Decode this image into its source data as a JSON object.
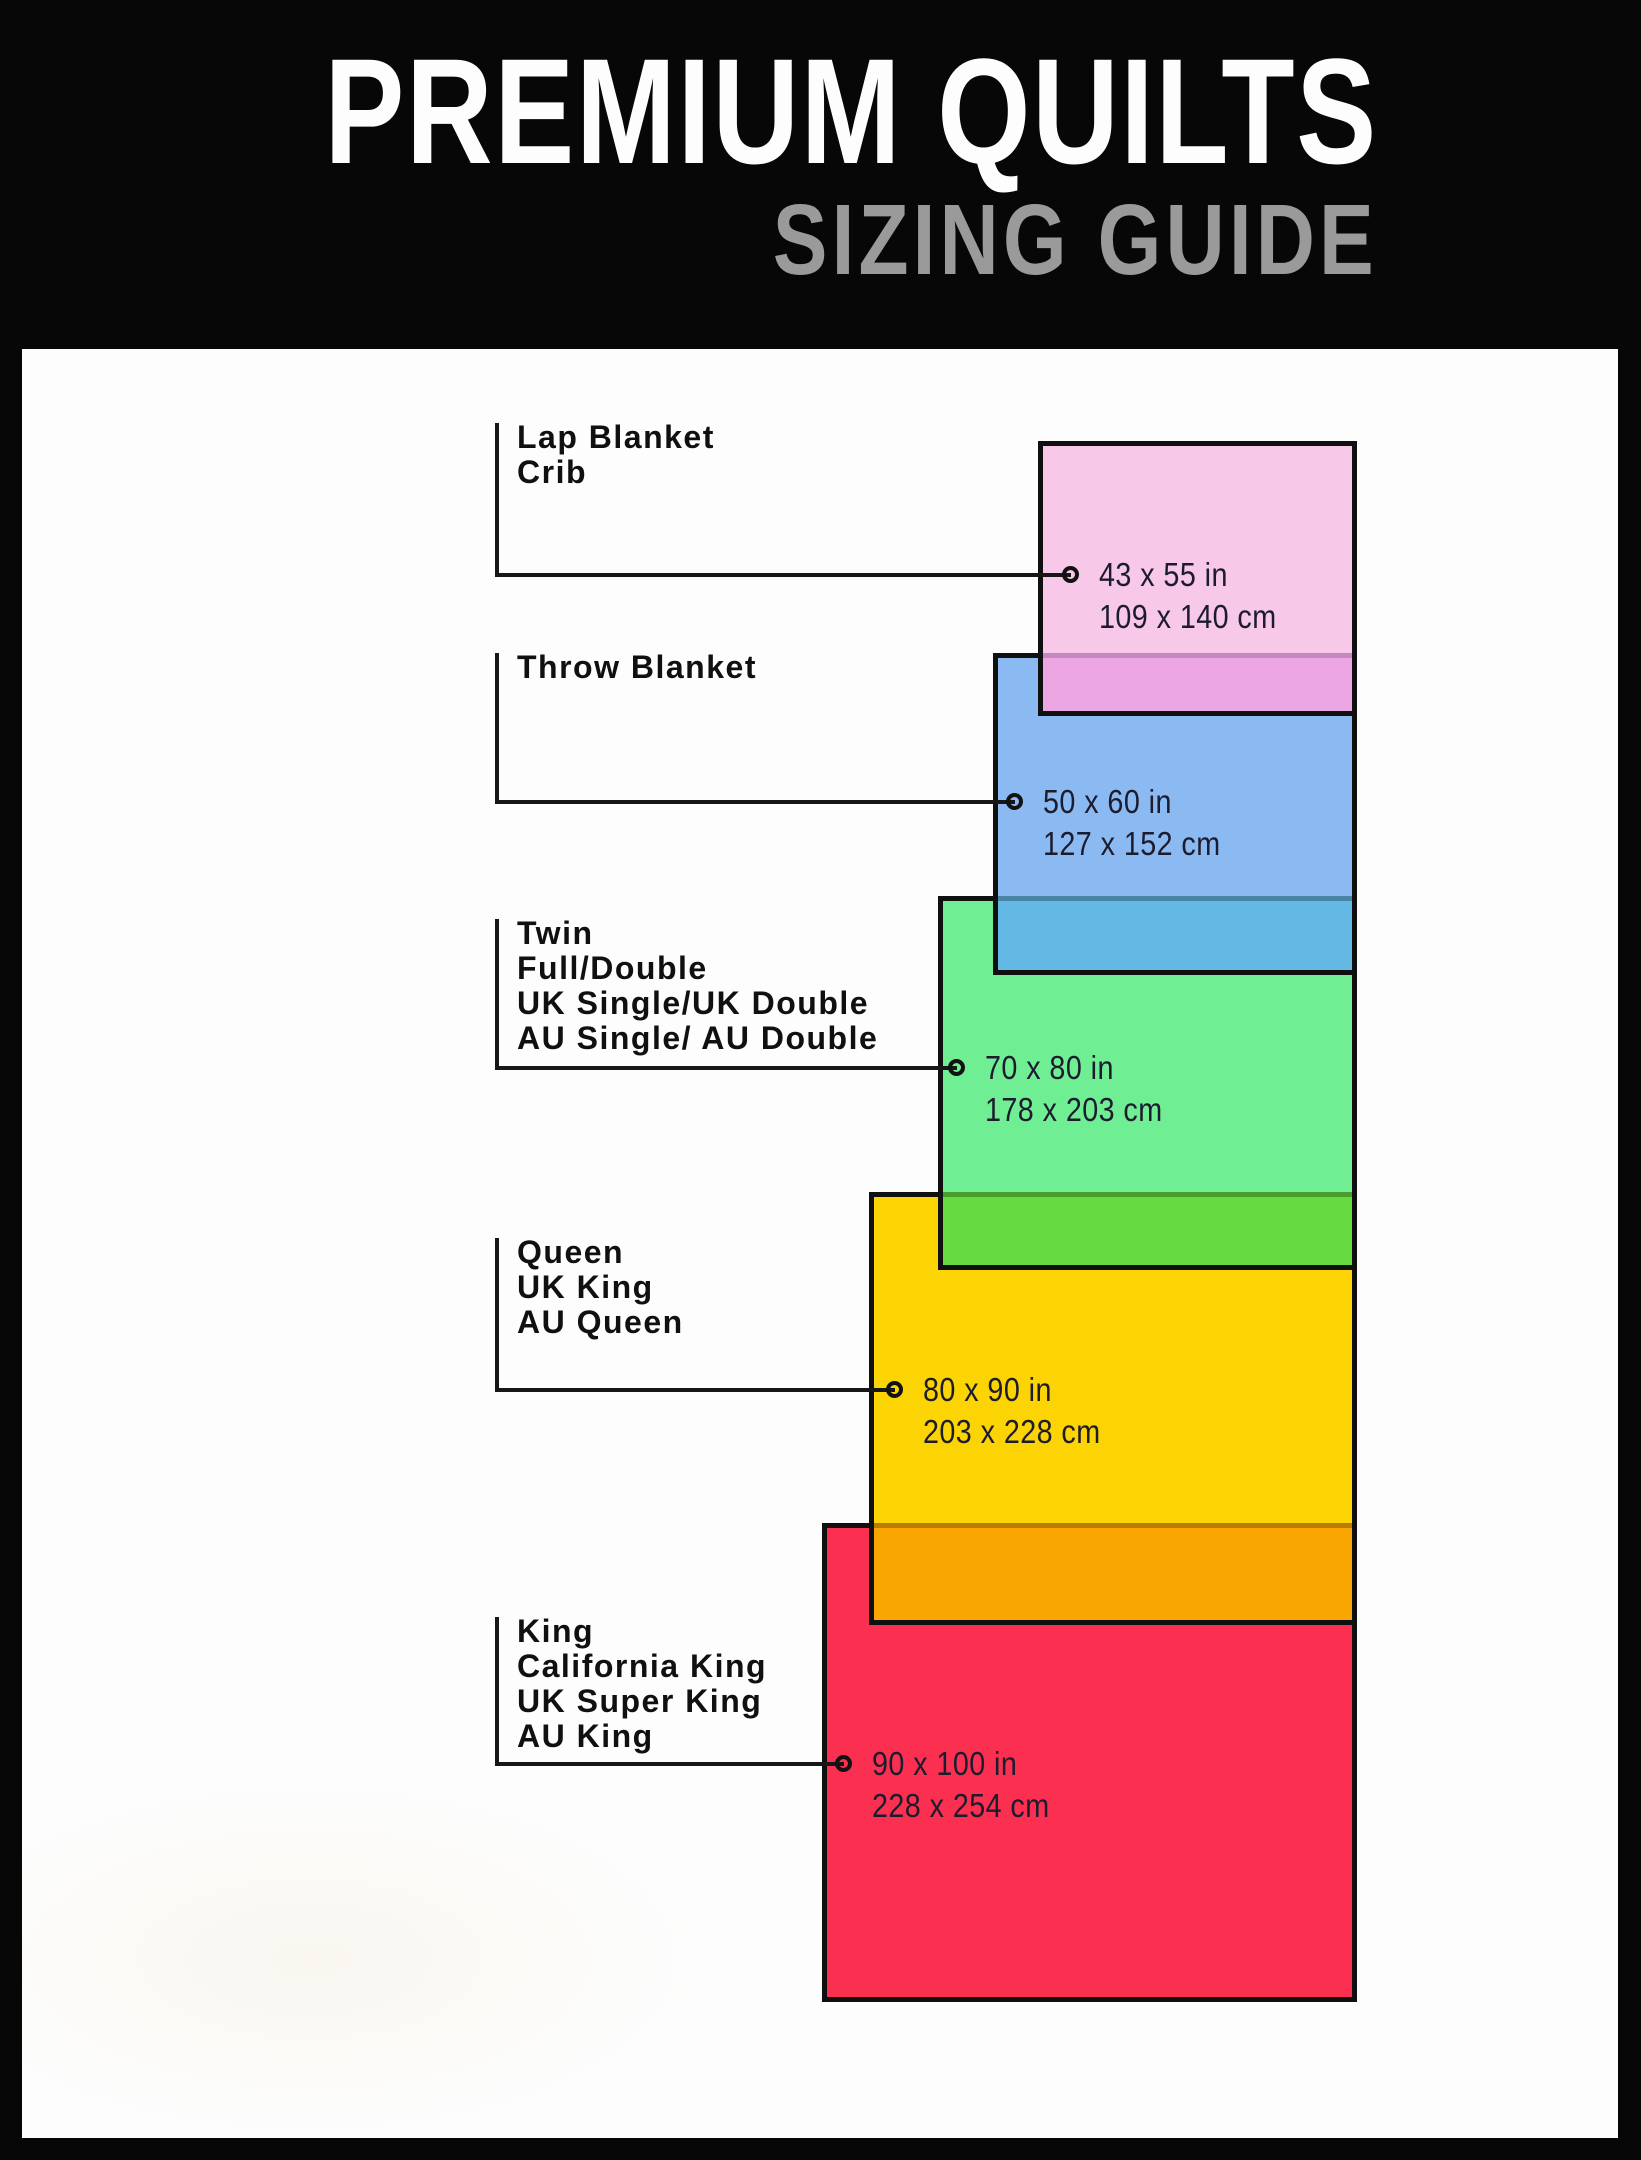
{
  "header": {
    "title": "PREMIUM QUILTS",
    "subtitle": "SIZING GUIDE",
    "bg_color": "#070707",
    "title_color": "#fdfdfd",
    "subtitle_color": "#9a9a9a"
  },
  "panel": {
    "bg_color": "#fdfdfd",
    "border_color": "#070707"
  },
  "quilts": [
    {
      "id": "lap-blanket-crib",
      "labels": [
        "Lap Blanket",
        "Crib"
      ],
      "size_in": "43 x 55 in",
      "size_cm": "109 x 140 cm",
      "fill": "#f8c8e8",
      "overlap_fill": "#eda6e4"
    },
    {
      "id": "throw-blanket",
      "labels": [
        "Throw Blanket"
      ],
      "size_in": "50 x 60 in",
      "size_cm": "127 x 152 cm",
      "fill": "#8bbaf3",
      "overlap_fill": "#64b8e4"
    },
    {
      "id": "twin-full-double",
      "labels": [
        "Twin",
        "Full/Double",
        "UK Single/UK Double",
        "AU Single/ AU Double"
      ],
      "size_in": "70 x 80 in",
      "size_cm": "178 x 203 cm",
      "fill": "#6fee94",
      "overlap_fill": "#64da3e"
    },
    {
      "id": "queen",
      "labels": [
        "Queen",
        "UK King",
        "AU Queen"
      ],
      "size_in": "80 x 90 in",
      "size_cm": "203 x 228 cm",
      "fill": "#fcd303",
      "overlap_fill": "#f9a603"
    },
    {
      "id": "king",
      "labels": [
        "King",
        "California King",
        "UK Super King",
        "AU King"
      ],
      "size_in": "90 x 100 in",
      "size_cm": "228 x 254 cm",
      "fill": "#fb3050",
      "overlap_fill": ""
    }
  ],
  "line_color": "#171717",
  "rect_border_color": "#101010",
  "text_color": "#1c1c2e"
}
